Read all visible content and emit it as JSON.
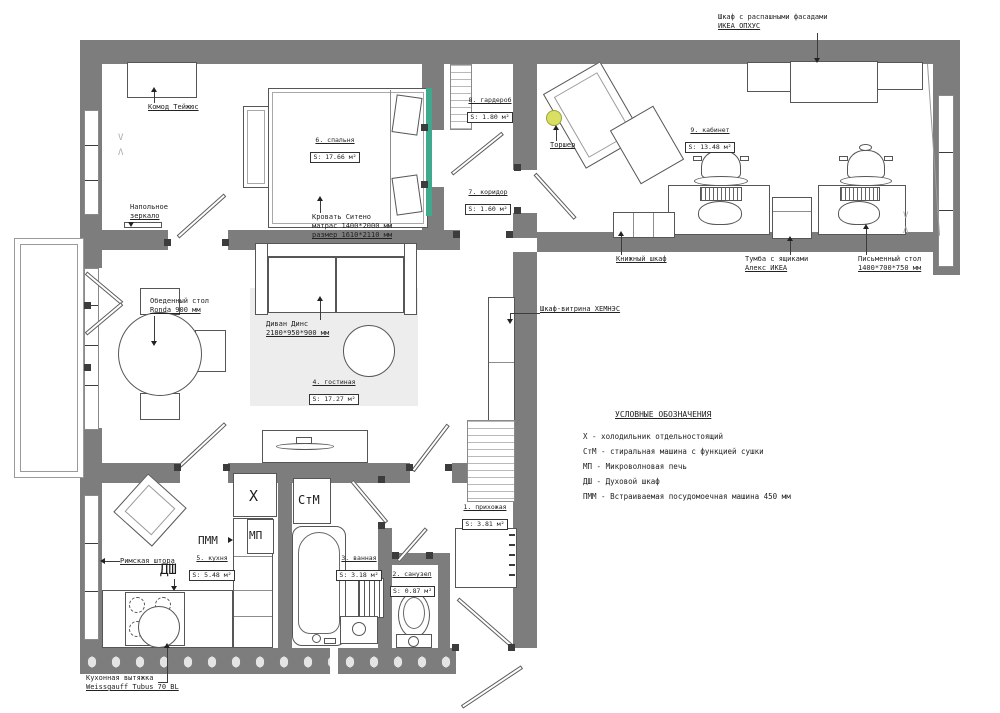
{
  "plan": {
    "rooms": {
      "hall": {
        "name": "1. прихожая",
        "area": "S: 3.81 м²"
      },
      "wc": {
        "name": "2. санузел",
        "area": "S: 0.87 м²"
      },
      "bath": {
        "name": "3. ванная",
        "area": "S: 3.18 м²"
      },
      "living": {
        "name": "4. гостиная",
        "area": "S: 17.27 м²"
      },
      "kitchen": {
        "name": "5. кухня",
        "area": "S: 5.48 м²"
      },
      "bedroom": {
        "name": "6. спальня",
        "area": "S: 17.66 м²"
      },
      "corridor": {
        "name": "7. коридор",
        "area": "S: 1.60 м²"
      },
      "wardrobe": {
        "name": "8. гардероб",
        "area": "S: 1.80 м²"
      },
      "office": {
        "name": "9. кабинет",
        "area": "S: 13.48 м²"
      }
    },
    "callouts": {
      "dresser": "Комод Тейжюс",
      "mirror1": "Напольное",
      "mirror2": "зеркало",
      "bed1": "Кровать Ситено",
      "bed2": "матрас 1400*2000 мм",
      "bed3": "размер 1610*2110 мм",
      "torcher": "Торшер",
      "ophus1": "Шкаф с распашными фасадами",
      "ophus2": "ИКЕА ОПХУС",
      "bookcase": "Книжный шкаф",
      "tumba1": "Тумба с ящиками",
      "tumba2": "Алекс ИКЕА",
      "desk1": "Письменный стол",
      "desk2": "1400*700*750 мм",
      "dining1": "Обеденный стол",
      "dining2": "Ronda 900 мм",
      "sofa1": "Диван Динс",
      "sofa2": "2180*950*900 мм",
      "vitrine": "Шкаф-витрина ХЕМНЭС",
      "blind": "Римская штора",
      "hood1": "Кухонная вытяжка",
      "hood2": "Weissgauff Tubus 70 BL"
    },
    "marks": {
      "fridge": "Х",
      "washer": "СтМ",
      "microwave": "МП",
      "oven": "ДШ",
      "dishwasher": "ПММ",
      "curtain_v": "V",
      "curtain_a": "Λ"
    },
    "legend": {
      "title": "УСЛОВНЫЕ ОБОЗНАЧЕНИЯ",
      "items": [
        "Х - холодильник отдельностоящий",
        "СтМ - стиральная машина с функцией сушки",
        "МП - Микроволновая печь",
        "ДШ - Духовой шкаф",
        "ПММ - Встраиваемая посудомоечная машина 450 мм"
      ]
    },
    "colors": {
      "wall": "#7d7d7d",
      "accent_green": "#3fa98e",
      "accent_yellow": "#d9e061"
    }
  }
}
